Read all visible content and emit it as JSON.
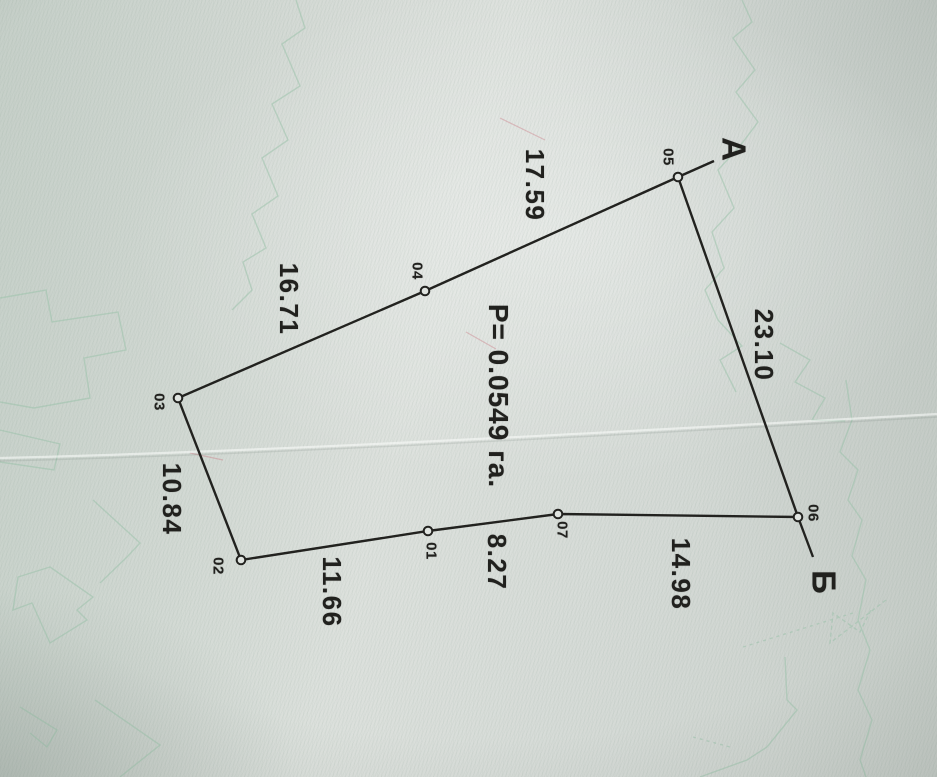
{
  "plan": {
    "kind": "land-parcel-survey-sketch",
    "area_label": "P= 0.0549 га.",
    "area_value_hectares": 0.0549,
    "directions": {
      "a": "А",
      "b": "Б"
    },
    "vertices": [
      {
        "id": "01"
      },
      {
        "id": "02"
      },
      {
        "id": "03"
      },
      {
        "id": "04"
      },
      {
        "id": "05"
      },
      {
        "id": "06"
      },
      {
        "id": "07"
      }
    ],
    "sides": [
      {
        "from": "05",
        "to": "06",
        "length": "23.10"
      },
      {
        "from": "06",
        "to": "07",
        "length": "14.98"
      },
      {
        "from": "07",
        "to": "01",
        "length": "8.27"
      },
      {
        "from": "01",
        "to": "02",
        "length": "11.66"
      },
      {
        "from": "02",
        "to": "03",
        "length": "10.84"
      },
      {
        "from": "03",
        "to": "04",
        "length": "16.71"
      },
      {
        "from": "04",
        "to": "05",
        "length": "17.59"
      }
    ]
  }
}
